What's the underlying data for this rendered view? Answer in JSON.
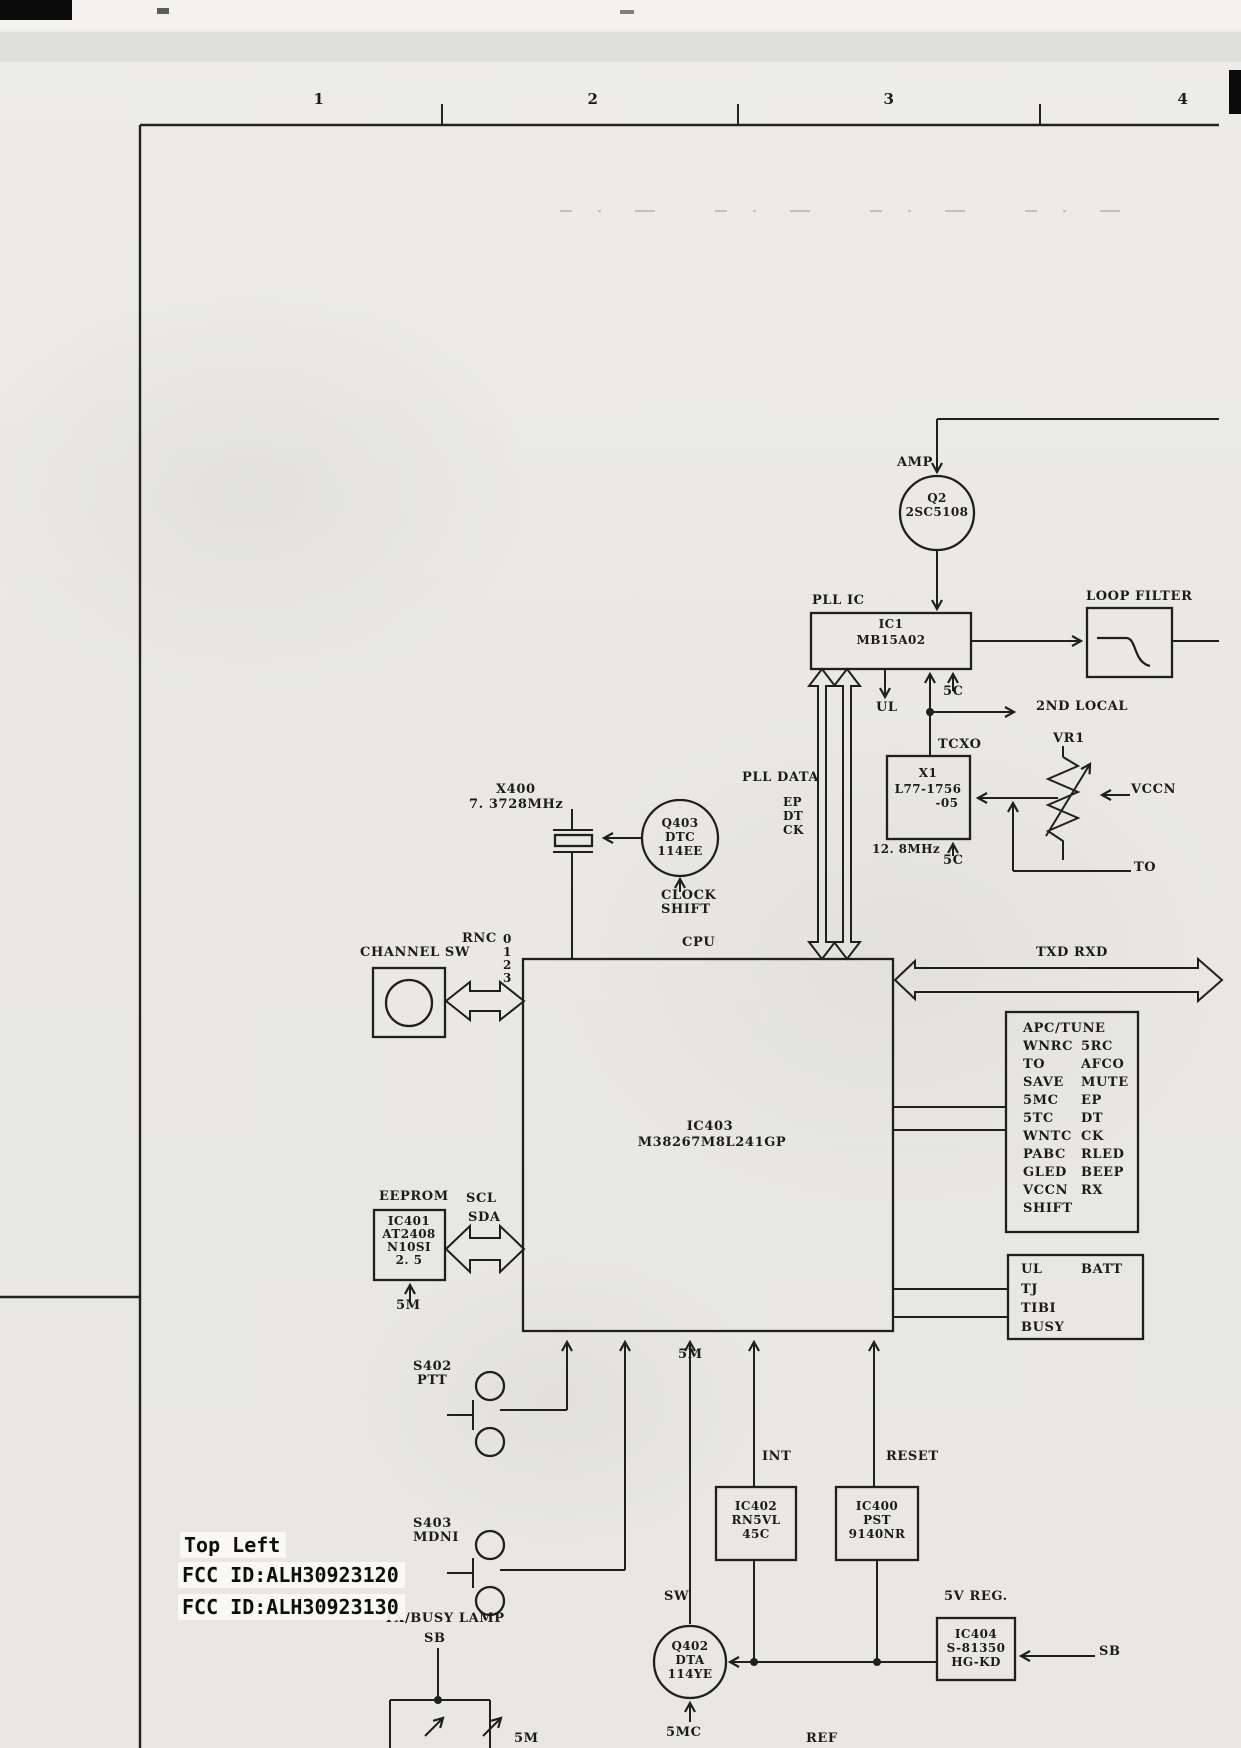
{
  "ruler": {
    "marks": [
      "1",
      "2",
      "3",
      "4"
    ]
  },
  "annotations": {
    "position": "Top Left",
    "fcc_id_1": "FCC ID:ALH30923120",
    "fcc_id_2": "FCC ID:ALH30923130"
  },
  "diagram": {
    "amp": {
      "label": "AMP",
      "ref": "Q2",
      "part": "2SC5108"
    },
    "pll": {
      "label": "PLL IC",
      "ref": "IC1",
      "part": "MB15A02",
      "ul": "UL",
      "vc": "5C",
      "data_label": "PLL DATA",
      "ep": "EP",
      "dt": "DT",
      "ck": "CK"
    },
    "loop_filter": {
      "label": "LOOP FILTER"
    },
    "second_local": {
      "label": "2ND LOCAL"
    },
    "tcxo": {
      "label": "TCXO",
      "ref": "X1",
      "part_line1": "L77-1756",
      "part_line2": "-05",
      "freq": "12. 8MHz",
      "vc": "5C"
    },
    "vr1": {
      "label": "VR1",
      "in": "VCCN",
      "out": "TO"
    },
    "xtal": {
      "ref": "X400",
      "freq": "7. 3728MHz"
    },
    "q403": {
      "ref": "Q403",
      "part_line1": "DTC",
      "part_line2": "114EE",
      "ctrl_line1": "CLOCK",
      "ctrl_line2": "SHIFT"
    },
    "channel_sw": {
      "label": "CHANNEL SW",
      "bus": "RNC",
      "bits": [
        "0",
        "1",
        "2",
        "3"
      ]
    },
    "cpu": {
      "label": "CPU",
      "ref": "IC403",
      "part": "M38267M8L241GP",
      "supply": "5M"
    },
    "serial": {
      "label": "TXD RXD"
    },
    "apc_tune": {
      "title": "APC/TUNE",
      "rows": [
        [
          "WNRC",
          "5RC"
        ],
        [
          "TO",
          "AFCO"
        ],
        [
          "SAVE",
          "MUTE"
        ],
        [
          "5MC",
          "EP"
        ],
        [
          "5TC",
          "DT"
        ],
        [
          "WNTC",
          "CK"
        ],
        [
          "PABC",
          "RLED"
        ],
        [
          "GLED",
          "BEEP"
        ],
        [
          "VCCN",
          "RX"
        ],
        [
          "SHIFT",
          ""
        ]
      ]
    },
    "status": {
      "rows_left": [
        "UL",
        "TJ",
        "TIBI",
        "BUSY"
      ],
      "right": "BATT"
    },
    "eeprom": {
      "label": "EEPROM",
      "ref": "IC401",
      "part_line1": "AT2408",
      "part_line2": "N10SI",
      "part_line3": "2. 5",
      "scl": "SCL",
      "sda": "SDA",
      "supply": "5M"
    },
    "ptt": {
      "ref": "S402",
      "name": "PTT"
    },
    "moni": {
      "ref": "S403",
      "name": "MDNI"
    },
    "int": {
      "label": "INT",
      "ref": "IC402",
      "part_line1": "RN5VL",
      "part_line2": "45C"
    },
    "reset": {
      "label": "RESET",
      "ref": "IC400",
      "part_line1": "PST",
      "part_line2": "9140NR"
    },
    "sw": {
      "label": "SW",
      "ref": "Q402",
      "part_line1": "DTA",
      "part_line2": "114YE",
      "supply": "5MC"
    },
    "vreg": {
      "label": "5V REG.",
      "ref": "IC404",
      "part_line1": "S-81350",
      "part_line2": "HG-KD",
      "input": "SB"
    },
    "lamp": {
      "label": "TX/BUSY LAMP",
      "sb": "SB"
    },
    "ref_line": {
      "label": "REF"
    },
    "partial": {
      "label": "5M"
    }
  }
}
